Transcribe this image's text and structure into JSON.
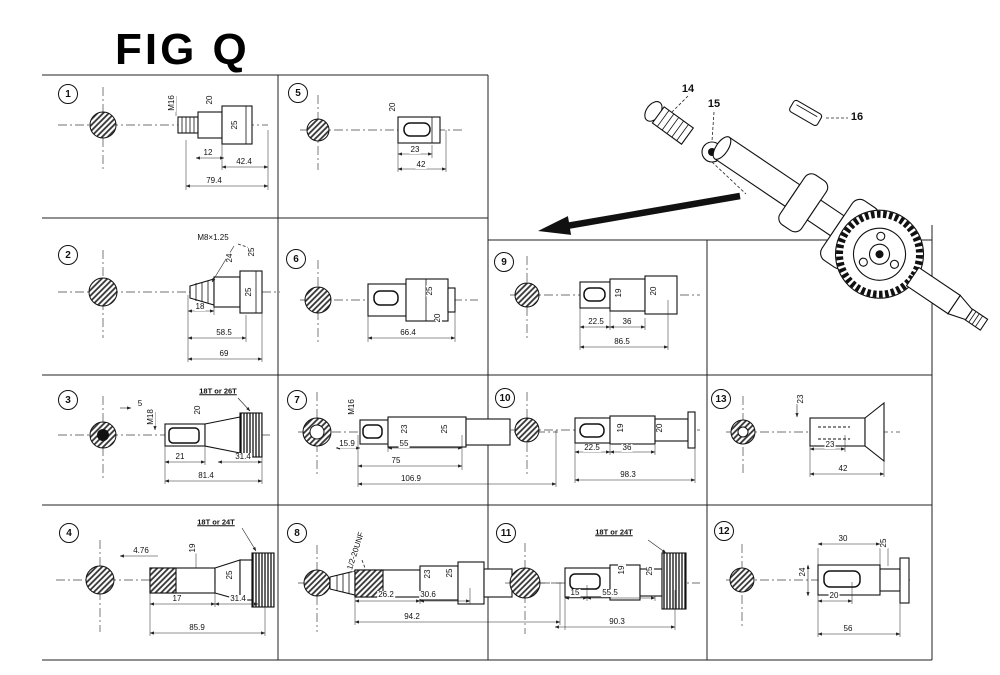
{
  "title": "FIG Q",
  "parts": [
    {
      "label": "14",
      "x": 688,
      "y": 89
    },
    {
      "label": "15",
      "x": 714,
      "y": 104
    },
    {
      "label": "16",
      "x": 857,
      "y": 117
    }
  ],
  "cells": [
    {
      "id": "1",
      "callout": {
        "x": 68,
        "y": 94
      },
      "labels": [
        {
          "t": "M16",
          "x": 172,
          "y": 103,
          "r": -90
        },
        {
          "t": "20",
          "x": 210,
          "y": 100,
          "r": -90
        },
        {
          "t": "25",
          "x": 235,
          "y": 125,
          "r": -90
        },
        {
          "t": "12",
          "x": 208,
          "y": 153
        },
        {
          "t": "42.4",
          "x": 244,
          "y": 162
        },
        {
          "t": "79.4",
          "x": 214,
          "y": 181
        }
      ]
    },
    {
      "id": "5",
      "callout": {
        "x": 298,
        "y": 93
      },
      "labels": [
        {
          "t": "20",
          "x": 393,
          "y": 107,
          "r": -90
        },
        {
          "t": "23",
          "x": 415,
          "y": 150
        },
        {
          "t": "42",
          "x": 421,
          "y": 165
        }
      ]
    },
    {
      "id": "2",
      "callout": {
        "x": 68,
        "y": 255
      },
      "labels": [
        {
          "t": "M8×1.25",
          "x": 213,
          "y": 238
        },
        {
          "t": "24",
          "x": 230,
          "y": 258,
          "r": -90
        },
        {
          "t": "25",
          "x": 252,
          "y": 252,
          "r": -90
        },
        {
          "t": "25",
          "x": 249,
          "y": 292,
          "r": -90
        },
        {
          "t": "18",
          "x": 200,
          "y": 307
        },
        {
          "t": "58.5",
          "x": 224,
          "y": 333
        },
        {
          "t": "69",
          "x": 224,
          "y": 354
        }
      ]
    },
    {
      "id": "6",
      "callout": {
        "x": 296,
        "y": 259
      },
      "labels": [
        {
          "t": "25",
          "x": 430,
          "y": 291,
          "r": -90
        },
        {
          "t": "20",
          "x": 438,
          "y": 318,
          "r": -90
        },
        {
          "t": "66.4",
          "x": 408,
          "y": 333
        }
      ]
    },
    {
      "id": "9",
      "callout": {
        "x": 504,
        "y": 262
      },
      "labels": [
        {
          "t": "19",
          "x": 619,
          "y": 293,
          "r": -90
        },
        {
          "t": "20",
          "x": 654,
          "y": 291,
          "r": -90
        },
        {
          "t": "22.5",
          "x": 596,
          "y": 322
        },
        {
          "t": "36",
          "x": 627,
          "y": 322
        },
        {
          "t": "86.5",
          "x": 622,
          "y": 342
        }
      ]
    },
    {
      "id": "3",
      "callout": {
        "x": 68,
        "y": 400
      },
      "labels": [
        {
          "t": "5",
          "x": 140,
          "y": 404
        },
        {
          "t": "M18",
          "x": 151,
          "y": 417,
          "r": -90
        },
        {
          "t": "20",
          "x": 198,
          "y": 410,
          "r": -90
        },
        {
          "t": "18T or 26T",
          "x": 218,
          "y": 391,
          "u": 1
        },
        {
          "t": "21",
          "x": 180,
          "y": 457
        },
        {
          "t": "31.4",
          "x": 243,
          "y": 457
        },
        {
          "t": "81.4",
          "x": 206,
          "y": 476
        }
      ]
    },
    {
      "id": "7",
      "callout": {
        "x": 297,
        "y": 400
      },
      "labels": [
        {
          "t": "M16",
          "x": 352,
          "y": 407,
          "r": -90
        },
        {
          "t": "23",
          "x": 405,
          "y": 429,
          "r": -90
        },
        {
          "t": "25",
          "x": 445,
          "y": 429,
          "r": -90
        },
        {
          "t": "15.9",
          "x": 347,
          "y": 444
        },
        {
          "t": "55",
          "x": 404,
          "y": 444
        },
        {
          "t": "75",
          "x": 396,
          "y": 461
        },
        {
          "t": "106.9",
          "x": 411,
          "y": 479
        }
      ]
    },
    {
      "id": "10",
      "callout": {
        "x": 505,
        "y": 398
      },
      "labels": [
        {
          "t": "19",
          "x": 621,
          "y": 428,
          "r": -90
        },
        {
          "t": "20",
          "x": 660,
          "y": 428,
          "r": -90
        },
        {
          "t": "22.5",
          "x": 592,
          "y": 448
        },
        {
          "t": "36",
          "x": 627,
          "y": 448
        },
        {
          "t": "98.3",
          "x": 628,
          "y": 475
        }
      ]
    },
    {
      "id": "13",
      "callout": {
        "x": 721,
        "y": 399
      },
      "labels": [
        {
          "t": "23",
          "x": 801,
          "y": 399,
          "r": -90
        },
        {
          "t": "23",
          "x": 830,
          "y": 445
        },
        {
          "t": "42",
          "x": 843,
          "y": 469
        }
      ]
    },
    {
      "id": "4",
      "callout": {
        "x": 69,
        "y": 533
      },
      "labels": [
        {
          "t": "4.76",
          "x": 141,
          "y": 551
        },
        {
          "t": "19",
          "x": 193,
          "y": 548,
          "r": -90
        },
        {
          "t": "25",
          "x": 230,
          "y": 575,
          "r": -90
        },
        {
          "t": "18T or 24T",
          "x": 216,
          "y": 522,
          "u": 1
        },
        {
          "t": "17",
          "x": 177,
          "y": 599
        },
        {
          "t": "31.4",
          "x": 238,
          "y": 599
        },
        {
          "t": "85.9",
          "x": 197,
          "y": 628
        }
      ]
    },
    {
      "id": "8",
      "callout": {
        "x": 297,
        "y": 533
      },
      "labels": [
        {
          "t": "1/2-20UNF",
          "x": 356,
          "y": 551,
          "r": -72
        },
        {
          "t": "23",
          "x": 428,
          "y": 574,
          "r": -90
        },
        {
          "t": "25",
          "x": 450,
          "y": 573,
          "r": -90
        },
        {
          "t": "26.2",
          "x": 386,
          "y": 595
        },
        {
          "t": "30.6",
          "x": 428,
          "y": 595
        },
        {
          "t": "94.2",
          "x": 412,
          "y": 617
        }
      ]
    },
    {
      "id": "11",
      "callout": {
        "x": 506,
        "y": 533
      },
      "labels": [
        {
          "t": "18T or 24T",
          "x": 614,
          "y": 532,
          "u": 1
        },
        {
          "t": "19",
          "x": 622,
          "y": 570,
          "r": -90
        },
        {
          "t": "25",
          "x": 650,
          "y": 571,
          "r": -90
        },
        {
          "t": "15",
          "x": 575,
          "y": 593
        },
        {
          "t": "55.5",
          "x": 610,
          "y": 593
        },
        {
          "t": "90.3",
          "x": 617,
          "y": 622
        }
      ]
    },
    {
      "id": "12",
      "callout": {
        "x": 724,
        "y": 531
      },
      "labels": [
        {
          "t": "30",
          "x": 843,
          "y": 539
        },
        {
          "t": "24",
          "x": 803,
          "y": 572,
          "r": -90
        },
        {
          "t": "25",
          "x": 884,
          "y": 543,
          "r": -90
        },
        {
          "t": "20",
          "x": 834,
          "y": 596
        },
        {
          "t": "56",
          "x": 848,
          "y": 629
        }
      ]
    }
  ]
}
